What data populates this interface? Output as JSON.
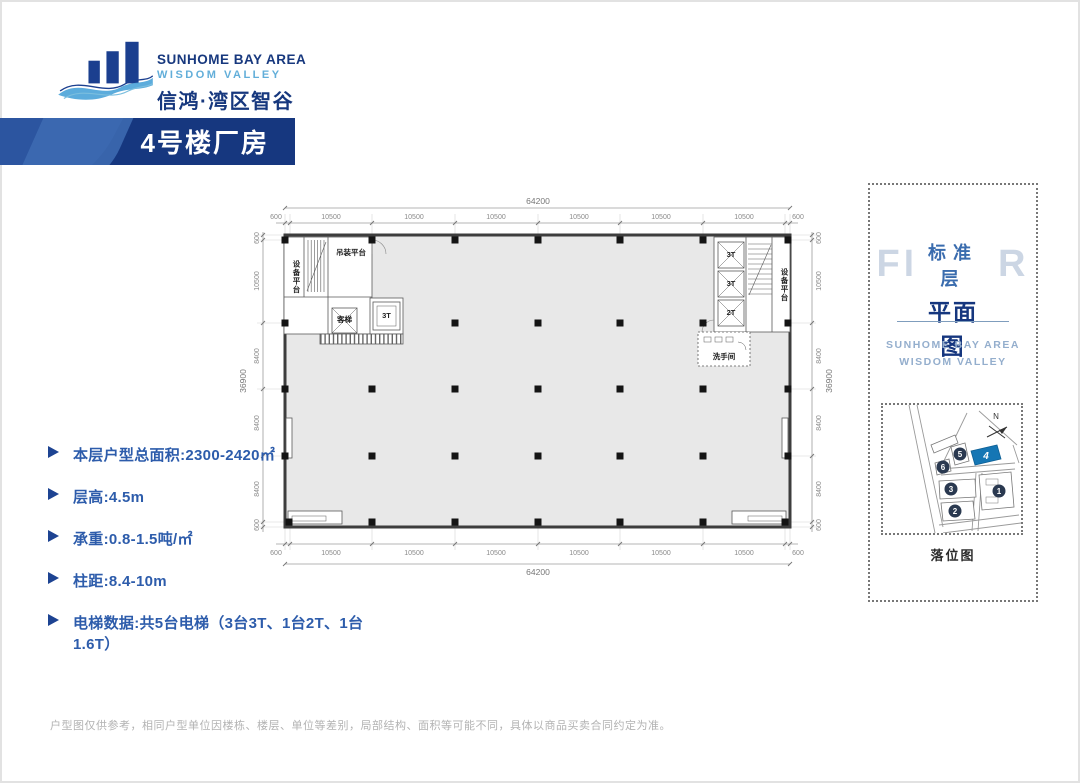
{
  "logo": {
    "name_en": "SUNHOME BAY AREA",
    "name_sub": "WISDOM VALLEY",
    "name_cn": "信鸿·湾区智谷"
  },
  "banner": {
    "title": "4号楼厂房"
  },
  "specs": {
    "items": [
      "本层户型总面积:2300-2420㎡",
      "层高:4.5m",
      "承重:0.8-1.5吨/㎡",
      "柱距:8.4-10m",
      "电梯数据:共5台电梯（3台3T、1台2T、1台1.6T）"
    ]
  },
  "floor_plan": {
    "dims": {
      "total_width": "64200",
      "total_height": "36900",
      "top_segments": [
        "600",
        "10500",
        "10500",
        "10500",
        "10500",
        "10500",
        "10500",
        "600"
      ],
      "bottom_segments": [
        "600",
        "10500",
        "10500",
        "10500",
        "10500",
        "10500",
        "10500",
        "600"
      ],
      "left_segments": [
        "600",
        "10500",
        "8400",
        "8400",
        "8400",
        "600"
      ],
      "right_segments": [
        "600",
        "10500",
        "8400",
        "8400",
        "8400",
        "600"
      ]
    },
    "labels": {
      "equipment_platform_left": "设备平台",
      "equipment_platform_right": "设备平台",
      "hoisting_platform": "吊装平台",
      "passenger_elevator": "客梯",
      "elevator_3t_left": "3T",
      "elevator_3t_a": "3T",
      "elevator_3t_b": "3T",
      "elevator_2t": "2T",
      "restroom": "洗手间"
    }
  },
  "side_panel": {
    "ghost_text": "FLOOR",
    "title_line1": "标准层",
    "title_line2": "平面图",
    "brand_line1": "SUNHOME BAY AREA",
    "brand_line2": "WISDOM VALLEY",
    "site_map": {
      "caption": "落位图",
      "north_label": "N",
      "building_numbers": [
        "1",
        "2",
        "3",
        "4",
        "5",
        "6"
      ],
      "highlighted_building": "4",
      "highlight_color": "#1576b4"
    }
  },
  "disclaimer": "户型图仅供参考，相同户型单位因楼栋、楼层、单位等差别，局部结构、面积等可能不同，具体以商品买卖合同约定为准。",
  "colors": {
    "brand_navy": "#17387e",
    "accent_blue": "#2d5cab",
    "light_blue": "#62aed9",
    "map_highlight": "#1576b4"
  }
}
